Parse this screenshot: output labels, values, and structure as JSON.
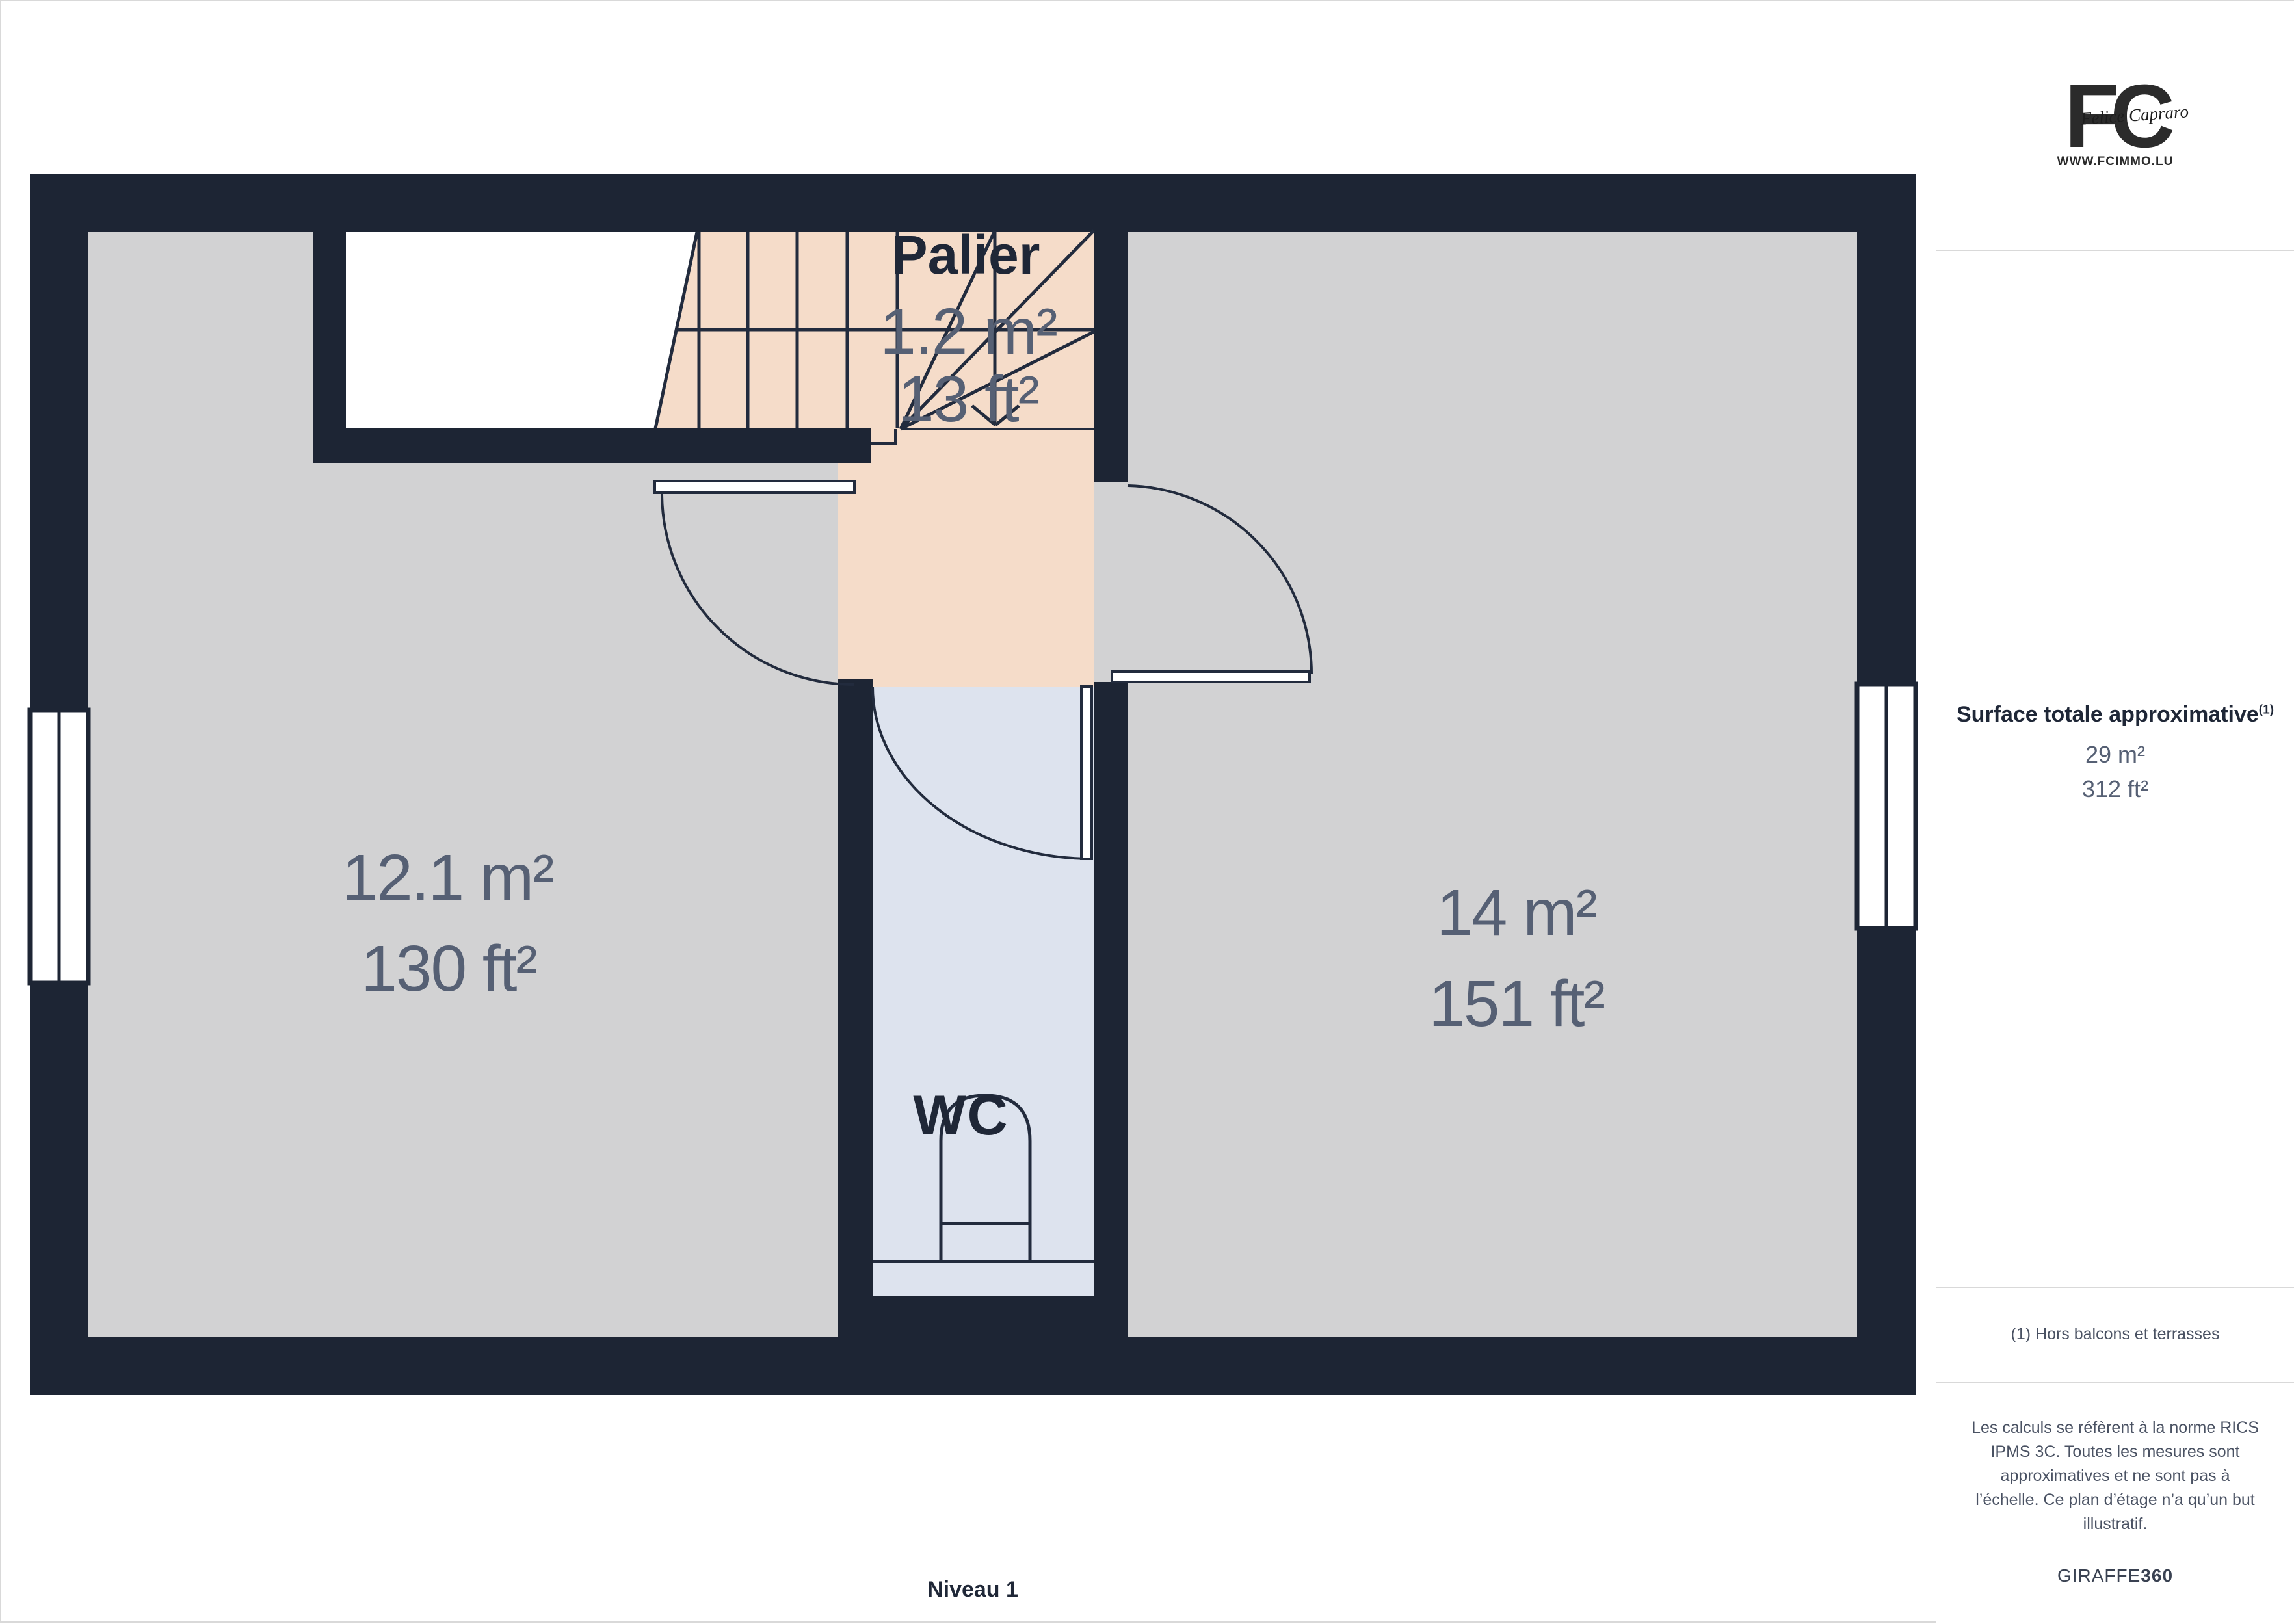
{
  "plan": {
    "level_label": "Niveau 1",
    "rooms": [
      {
        "name": "Palier",
        "area_m2": "1.2 m²",
        "area_ft2": "13 ft²"
      },
      {
        "name": "",
        "area_m2": "12.1 m²",
        "area_ft2": "130 ft²"
      },
      {
        "name": "",
        "area_m2": "14 m²",
        "area_ft2": "151 ft²"
      },
      {
        "name": "WC",
        "area_m2": "",
        "area_ft2": ""
      }
    ]
  },
  "sidebar": {
    "logo": {
      "monogram": "FC",
      "script": "Felice Capraro",
      "website": "WWW.FCIMMO.LU"
    },
    "surface": {
      "title": "Surface totale approximative",
      "superscript": "(1)",
      "m2": "29 m²",
      "ft2": "312 ft²"
    },
    "footnote": "(1) Hors balcons et terrasses",
    "legal_lines": [
      "Les calculs se réfèrent à la norme RICS",
      "IPMS 3C. Toutes les mesures sont",
      "approximatives et ne sont pas à",
      "l’échelle. Ce plan d’étage n’a qu’un but",
      "illustratif."
    ],
    "brand": {
      "normal": "GIRAFFE",
      "bold": "360"
    }
  },
  "colors": {
    "wall": "#1d2534",
    "floor": "#d2d2d3",
    "stairs": "#f5dcc9",
    "wcfloor": "#dde3ee",
    "line": "#222b3d",
    "labelgray": "#566074",
    "divider": "#d9d9d9",
    "textdark": "#1f2737",
    "footnote": "#4a5263",
    "logo": "#2b2b2b",
    "page": "#ffffff"
  }
}
